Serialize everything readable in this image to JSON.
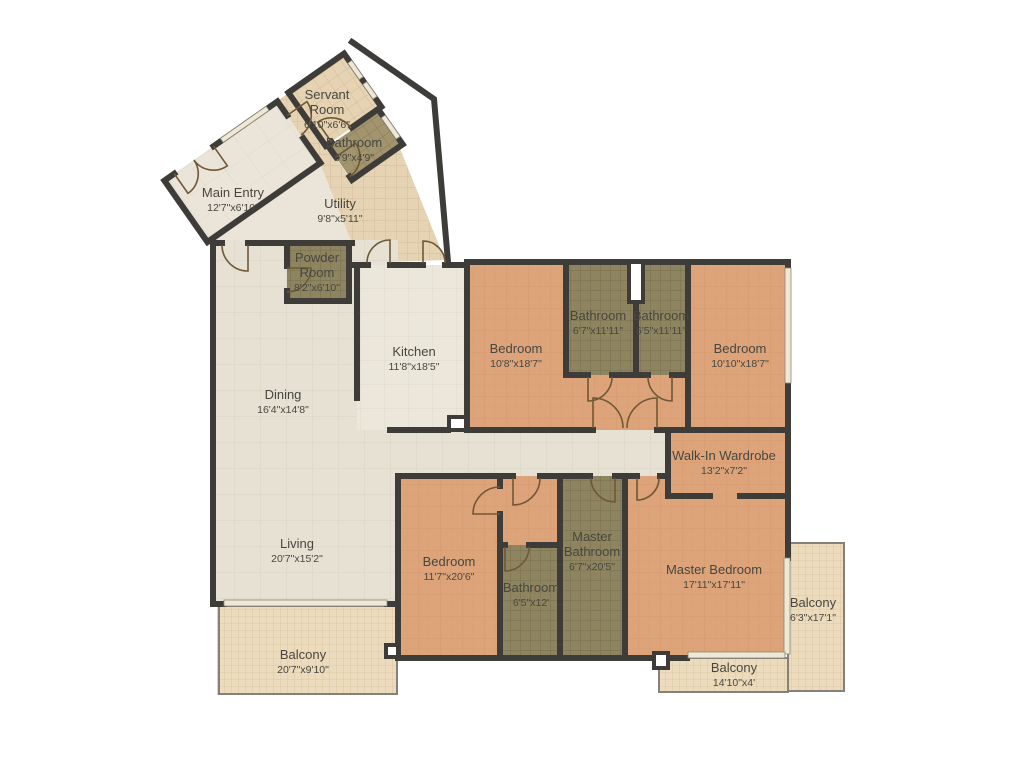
{
  "palette": {
    "wall": "#3e3c39",
    "label": "#474740",
    "bedroom_floor": "#dda47b",
    "bath_floor": "#8e8560",
    "living_floor": "#e7e1d3",
    "kitchen_floor": "#ece7db",
    "utility_floor": "#e5d3b3",
    "balcony_floor": "#ecdcbd",
    "background": "#ffffff"
  },
  "rooms": [
    {
      "id": "servant-room",
      "name_lines": [
        "Servant",
        "Room"
      ],
      "dims": "6'10\"x6'6\"",
      "cx": 327,
      "cy": 99
    },
    {
      "id": "servant-bathroom",
      "name_lines": [
        "Bathroom"
      ],
      "dims": "6'9\"x4'9\"",
      "cx": 354,
      "cy": 147
    },
    {
      "id": "main-entry",
      "name_lines": [
        "Main Entry"
      ],
      "dims": "12'7\"x6'10\"",
      "cx": 233,
      "cy": 197
    },
    {
      "id": "utility",
      "name_lines": [
        "Utility"
      ],
      "dims": "9'8\"x5'11\"",
      "cx": 340,
      "cy": 208
    },
    {
      "id": "powder-room",
      "name_lines": [
        "Powder",
        "Room"
      ],
      "dims": "8'2\"x6'10\"",
      "cx": 317,
      "cy": 262
    },
    {
      "id": "kitchen",
      "name_lines": [
        "Kitchen"
      ],
      "dims": "11'8\"x18'5\"",
      "cx": 414,
      "cy": 356
    },
    {
      "id": "bedroom-1",
      "name_lines": [
        "Bedroom"
      ],
      "dims": "10'8\"x18'7\"",
      "cx": 516,
      "cy": 353
    },
    {
      "id": "bathroom-1",
      "name_lines": [
        "Bathroom"
      ],
      "dims": "6'7\"x11'11\"",
      "cx": 598,
      "cy": 320
    },
    {
      "id": "bathroom-2",
      "name_lines": [
        "Bathroom"
      ],
      "dims": "6'5\"x11'11\"",
      "cx": 661,
      "cy": 320
    },
    {
      "id": "bedroom-2",
      "name_lines": [
        "Bedroom"
      ],
      "dims": "10'10\"x18'7\"",
      "cx": 740,
      "cy": 353
    },
    {
      "id": "dining",
      "name_lines": [
        "Dining"
      ],
      "dims": "16'4\"x14'8\"",
      "cx": 283,
      "cy": 399
    },
    {
      "id": "walk-in-wardrobe",
      "name_lines": [
        "Walk-In Wardrobe"
      ],
      "dims": "13'2\"x7'2\"",
      "cx": 724,
      "cy": 460
    },
    {
      "id": "living",
      "name_lines": [
        "Living"
      ],
      "dims": "20'7\"x15'2\"",
      "cx": 297,
      "cy": 548
    },
    {
      "id": "bedroom-3",
      "name_lines": [
        "Bedroom"
      ],
      "dims": "11'7\"x20'6\"",
      "cx": 449,
      "cy": 566
    },
    {
      "id": "bathroom-3",
      "name_lines": [
        "Bathroom"
      ],
      "dims": "6'5\"x12'",
      "cx": 531,
      "cy": 592
    },
    {
      "id": "master-bathroom",
      "name_lines": [
        "Master",
        "Bathroom"
      ],
      "dims": "6'7\"x20'5\"",
      "cx": 592,
      "cy": 541
    },
    {
      "id": "master-bedroom",
      "name_lines": [
        "Master Bedroom"
      ],
      "dims": "17'11\"x17'11\"",
      "cx": 714,
      "cy": 574
    },
    {
      "id": "balcony-right",
      "name_lines": [
        "Balcony"
      ],
      "dims": "6'3\"x17'1\"",
      "cx": 813,
      "cy": 607
    },
    {
      "id": "balcony-left",
      "name_lines": [
        "Balcony"
      ],
      "dims": "20'7\"x9'10\"",
      "cx": 303,
      "cy": 659
    },
    {
      "id": "balcony-bottom",
      "name_lines": [
        "Balcony"
      ],
      "dims": "14'10\"x4'",
      "cx": 734,
      "cy": 672
    }
  ]
}
